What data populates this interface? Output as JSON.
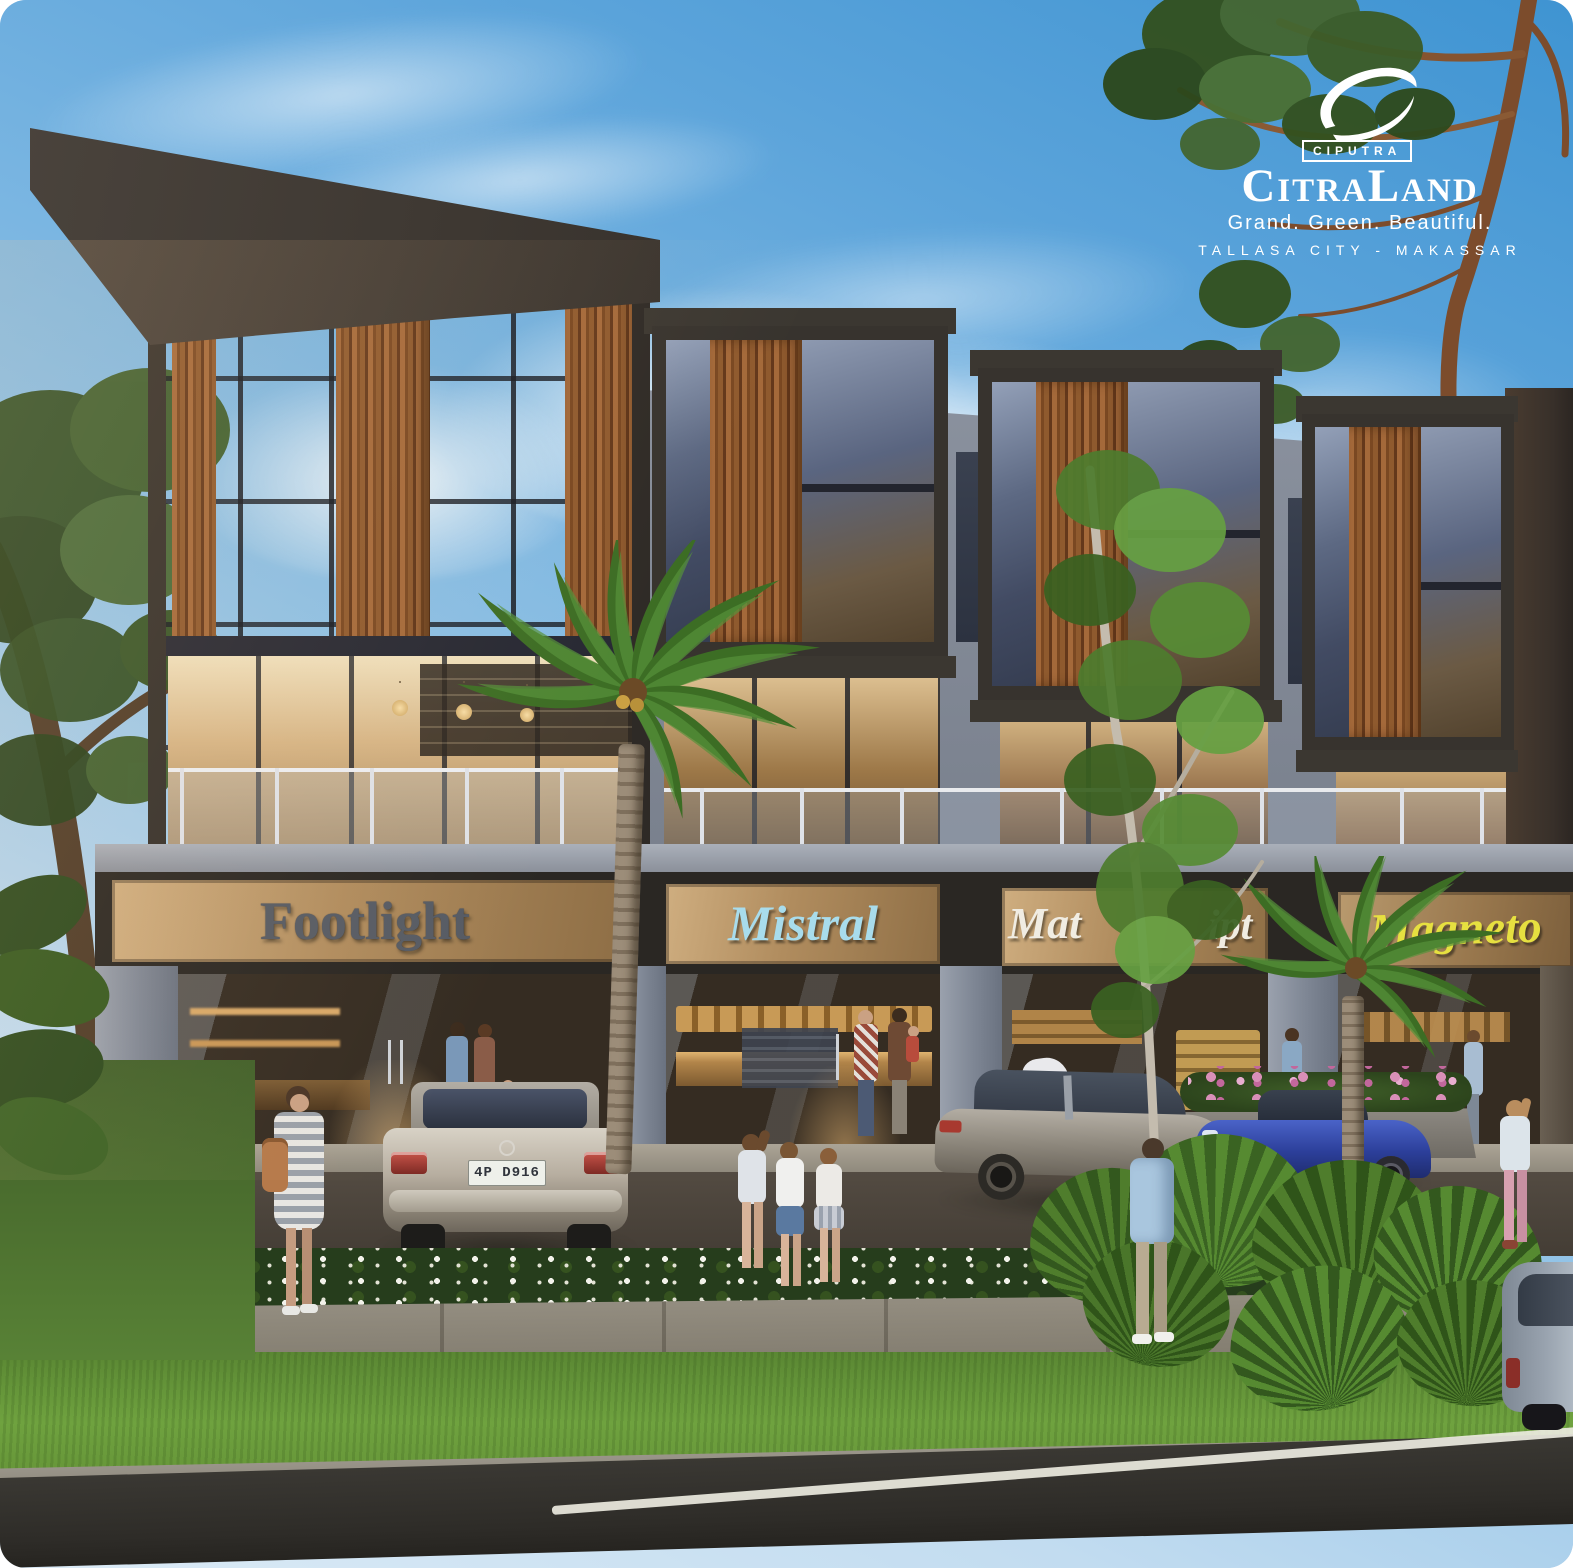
{
  "scene": {
    "type": "architectural rendering",
    "description": "Dusk view of a modern three-storey shophouse row (ruko) with wood-slat and glass facade, four retail units, parked cars, palms, pedestrians, lawn and road in the foreground",
    "floors": 3,
    "retail_units": 4,
    "palette": {
      "sky_top": "#4e9ed6",
      "sky_light": "#c2dcf0",
      "roof_dark": "#332f2c",
      "wall_gray": "#848b97",
      "wood": "#8f5a2e",
      "glass_blue": "#5a6680",
      "warm_interior": "#caa36a",
      "sign_band_tan": "#b08c5e",
      "grass_green": "#5a8733",
      "road_asphalt": "#34322e"
    }
  },
  "logo": {
    "mark": "ciputra-swoosh",
    "company": "CIPUTRA",
    "name": "CitraLand",
    "tagline": "Grand. Green. Beautiful.",
    "location": "TALLASA CITY - MAKASSAR"
  },
  "storefronts": [
    {
      "name": "Footlight",
      "sign_color": "#565b64",
      "style": "metal serif letters on tan band"
    },
    {
      "name": "Mistral",
      "sign_color": "#a8dcec",
      "style": "light-blue script",
      "interior": "bakery counter with breads and stacked boxes"
    },
    {
      "name_visible": "Mat…ipt",
      "fragment_left": "Mat",
      "fragment_right": "ipt",
      "sign_color": "#f0ece2",
      "note": "white script sign partially hidden behind tree"
    },
    {
      "name": "Magneto",
      "sign_color": "#e6e040",
      "style": "yellow italic script"
    }
  ],
  "vehicles": [
    {
      "type": "sedan",
      "color": "silver",
      "view": "rear",
      "plate": "4P D916"
    },
    {
      "type": "sedan",
      "color": "gray",
      "view": "rear three-quarter"
    },
    {
      "type": "sports-car",
      "color": "blue",
      "view": "front three-quarter behind shrubs"
    },
    {
      "type": "car",
      "color": "gray-blue",
      "view": "partial, bottom-right corner on road"
    }
  ],
  "people": [
    "woman in striped dress with tan shoulder bag on sidewalk",
    "three children walking on sidewalk",
    "man in light blue jacket standing near cars",
    "family with baby stroller at bakery storefront",
    "couple with child at Footlight entrance",
    "shopper at third storefront",
    "girl in pink pants at right storefront",
    "woman at Magneto storefront"
  ],
  "landscape": {
    "items": [
      "two coconut palms in front of facade",
      "slender tree screening third shop sign",
      "large fan-palm shrubs at right",
      "tree branches overhanging from top right",
      "shade tree at left edge",
      "white flower bed strip",
      "pink flower planter box",
      "lawn strip and asphalt road with white edge line"
    ]
  }
}
